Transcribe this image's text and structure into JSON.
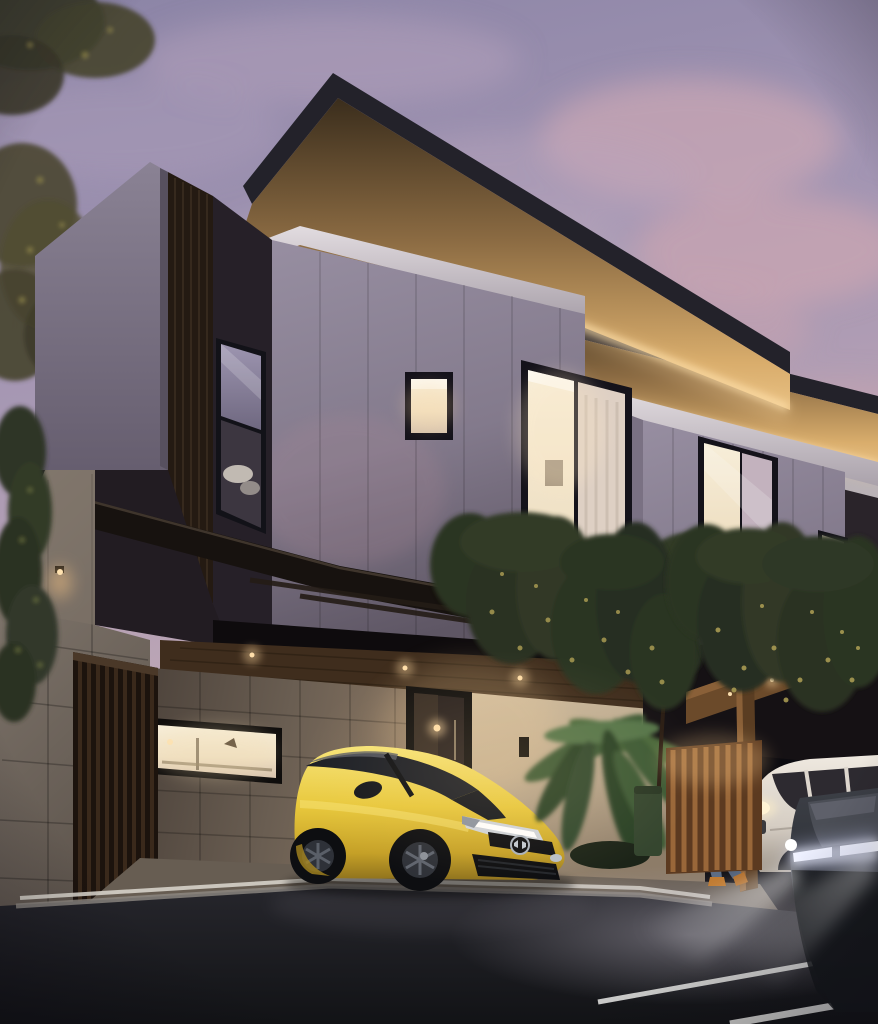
{
  "scene": {
    "type": "architectural-exterior-render",
    "time_of_day": "dusk",
    "setting": "modern two-storey townhouse pair with carports, street in foreground",
    "objects": [
      "dusk-sky-with-pink-clouds",
      "cantilevered-flat-roof-with-wood-soffit-and-led-strip",
      "gray-panel-upper-facade",
      "light-parapet-wall",
      "dark-wood-slat-column",
      "tall-window-reflecting-car",
      "lit-square-window",
      "lit-sliding-door-with-curtains",
      "balcony-with-cascading-vines",
      "second-unit-facade-with-lit-window",
      "dark-timber-carport-canopy",
      "stone-boundary-wall",
      "timber-slat-gate",
      "lit-kitchen-strip-window",
      "entrance-door-with-pendant-light",
      "palm-plant",
      "small-tree",
      "green-bin",
      "warm-lit-slat-fence",
      "yellow-honda-hatchback",
      "white-suv",
      "dark-car-with-led-drl-and-headlight-beam",
      "man-leaning-on-post-with-phone",
      "asphalt-road-with-lane-markings",
      "concrete-curb",
      "driveway-slab",
      "left-tree-foliage",
      "ivy-on-stone-wall",
      "wall-lamp"
    ],
    "lighting": [
      "warm led strips under roof soffits",
      "interior warm lights",
      "car headlight pool on road",
      "dusk ambient"
    ]
  },
  "palette": {
    "sky_top": "#8b84a6",
    "sky_mid": "#a295b3",
    "sky_low": "#bda7b6",
    "cloud_pink": "#cfa9b3",
    "roof_fascia": "#23222a",
    "soffit_dark": "#42331f",
    "soffit_mid": "#8a6a42",
    "soffit_glow": "#e8c083",
    "led_glow": "#ffe3ae",
    "wall_gray": "#8d8496",
    "wall_gray_dark": "#6f6679",
    "parapet": "#87808f",
    "dark_wall": "#2c2630",
    "dark_strip": "#262028",
    "slat_wood": "#241a12",
    "white_fascia": "#d5ced4",
    "window_frame": "#14121a",
    "glass_sky": "#8d86a2",
    "glass_lit": "#f3e7cf",
    "stone": "#7c7269",
    "stone_dark": "#574d45",
    "beige_wall": "#c3b096",
    "wood_ceiling": "#3f2d1d",
    "canopy_dark": "#17120f",
    "plant_dark": "#2c3423",
    "plant_light": "#7c8648",
    "plant_warm": "#a89a52",
    "fence_wood": "#8a5c32",
    "fence_lit": "#b07c42",
    "bin_green": "#35462f",
    "car_yellow": "#e8c83c",
    "car_yellow_hi": "#f7e478",
    "car_yellow_sh": "#8f721d",
    "car_glass": "#1c1f26",
    "chrome": "#d7dbe0",
    "suv_white": "#ddd6cd",
    "dark_car": "#2f3238",
    "drl_white": "#ffffff",
    "road": "#1b1c20",
    "curb": "#d6d1c9",
    "curb_shadow": "#8f8a83",
    "driveway": "#675d52",
    "skin": "#c49a78",
    "hoodie": "#a29da0",
    "jeans": "#5c6c84",
    "shoe_orange": "#c07a30",
    "lamp_warm": "#ffd9a0"
  }
}
